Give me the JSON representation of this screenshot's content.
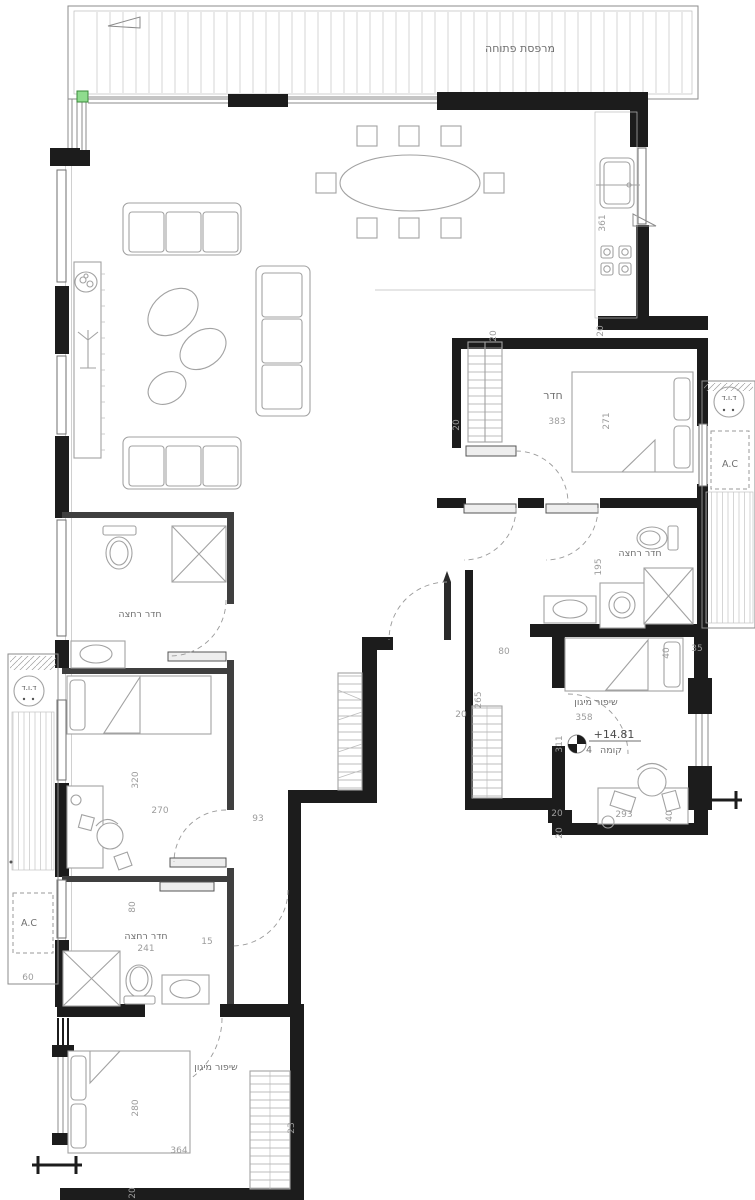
{
  "plan": {
    "type": "residential apartment floor plan",
    "labels": {
      "open_balcony": "מרפסת פתוחה",
      "room": "חדר",
      "bathroom": "חדר רחצה",
      "safe_room": "שיפור מיגון",
      "boiler": "ד.ו.ד",
      "ac": "A.C",
      "elevation_value": "+14.81",
      "elevation_floor": "קומה",
      "elevation_floor_number": "4"
    },
    "dimensions": {
      "d361": "361",
      "d383": "383",
      "d271": "271",
      "d195": "195",
      "d358": "358",
      "d311": "311",
      "d293": "293",
      "d265": "265",
      "d320": "320",
      "d270": "270",
      "d93": "93",
      "d241": "241",
      "d15": "15",
      "d280": "280",
      "d364": "364",
      "d23": "23",
      "d60": "60",
      "d35": "35",
      "d20": "20",
      "d40": "40",
      "d80": "80"
    },
    "colors": {
      "marker_green": "#8fdc8e",
      "wall": "#1c1c1c",
      "dim_text": "#9c9c9c",
      "label_text": "#6f6f6f"
    }
  }
}
